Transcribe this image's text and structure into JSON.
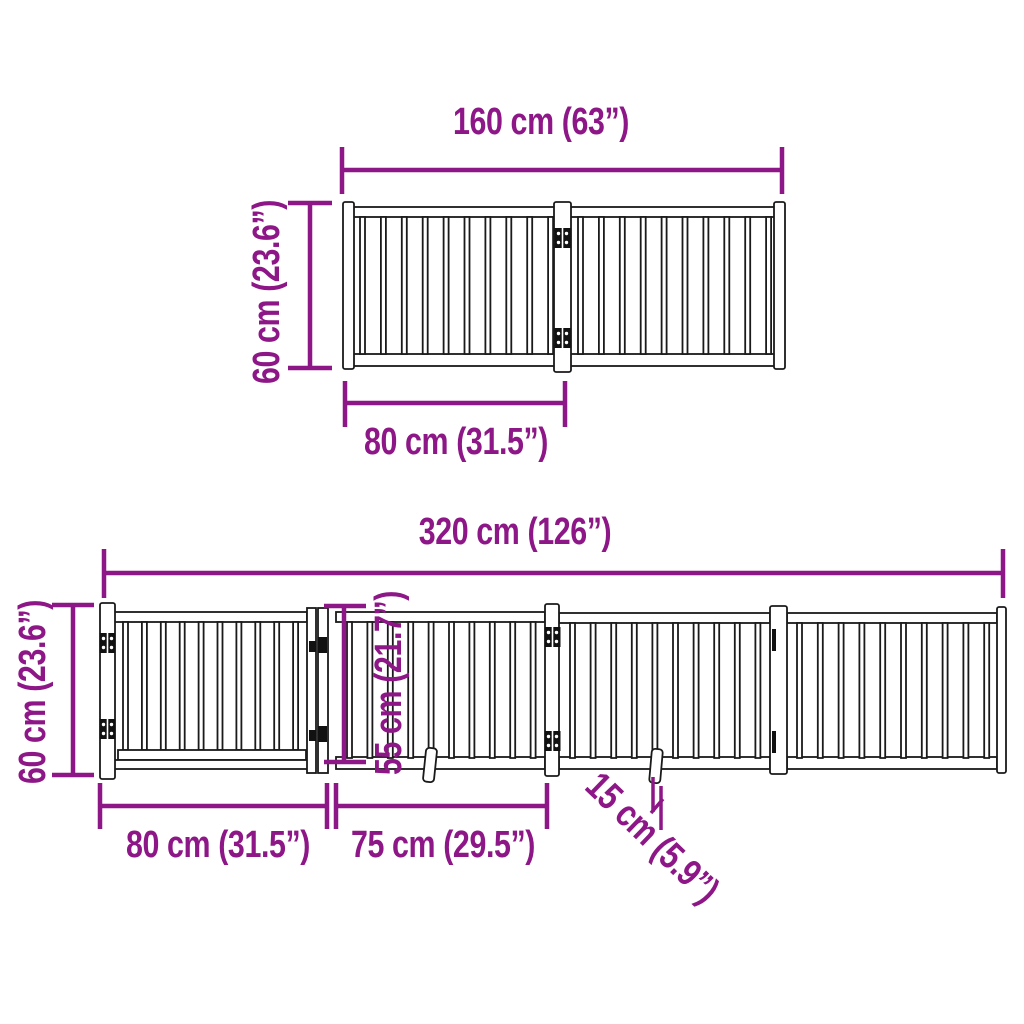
{
  "style": {
    "dimension_color": "#8D1787",
    "outline_color": "#1a1a1a",
    "background": "#ffffff"
  },
  "top_diagram": {
    "panels": 2,
    "slats_per_panel": 10,
    "hinge_pairs": 1,
    "labels": {
      "total_width": "160 cm (63”)",
      "height": "60 cm (23.6”)",
      "panel_width": "80 cm (31.5”)"
    }
  },
  "bottom_diagram": {
    "sections": 4,
    "slats_per_panel": 10,
    "feet": 2,
    "labels": {
      "total_width": "320 cm (126”)",
      "height": "60 cm (23.6”)",
      "section1_width": "80 cm (31.5”)",
      "section2_width": "75 cm (29.5”)",
      "door_height": "55 cm (21.7”)",
      "foot_depth": "15 cm (5.9”)"
    }
  }
}
